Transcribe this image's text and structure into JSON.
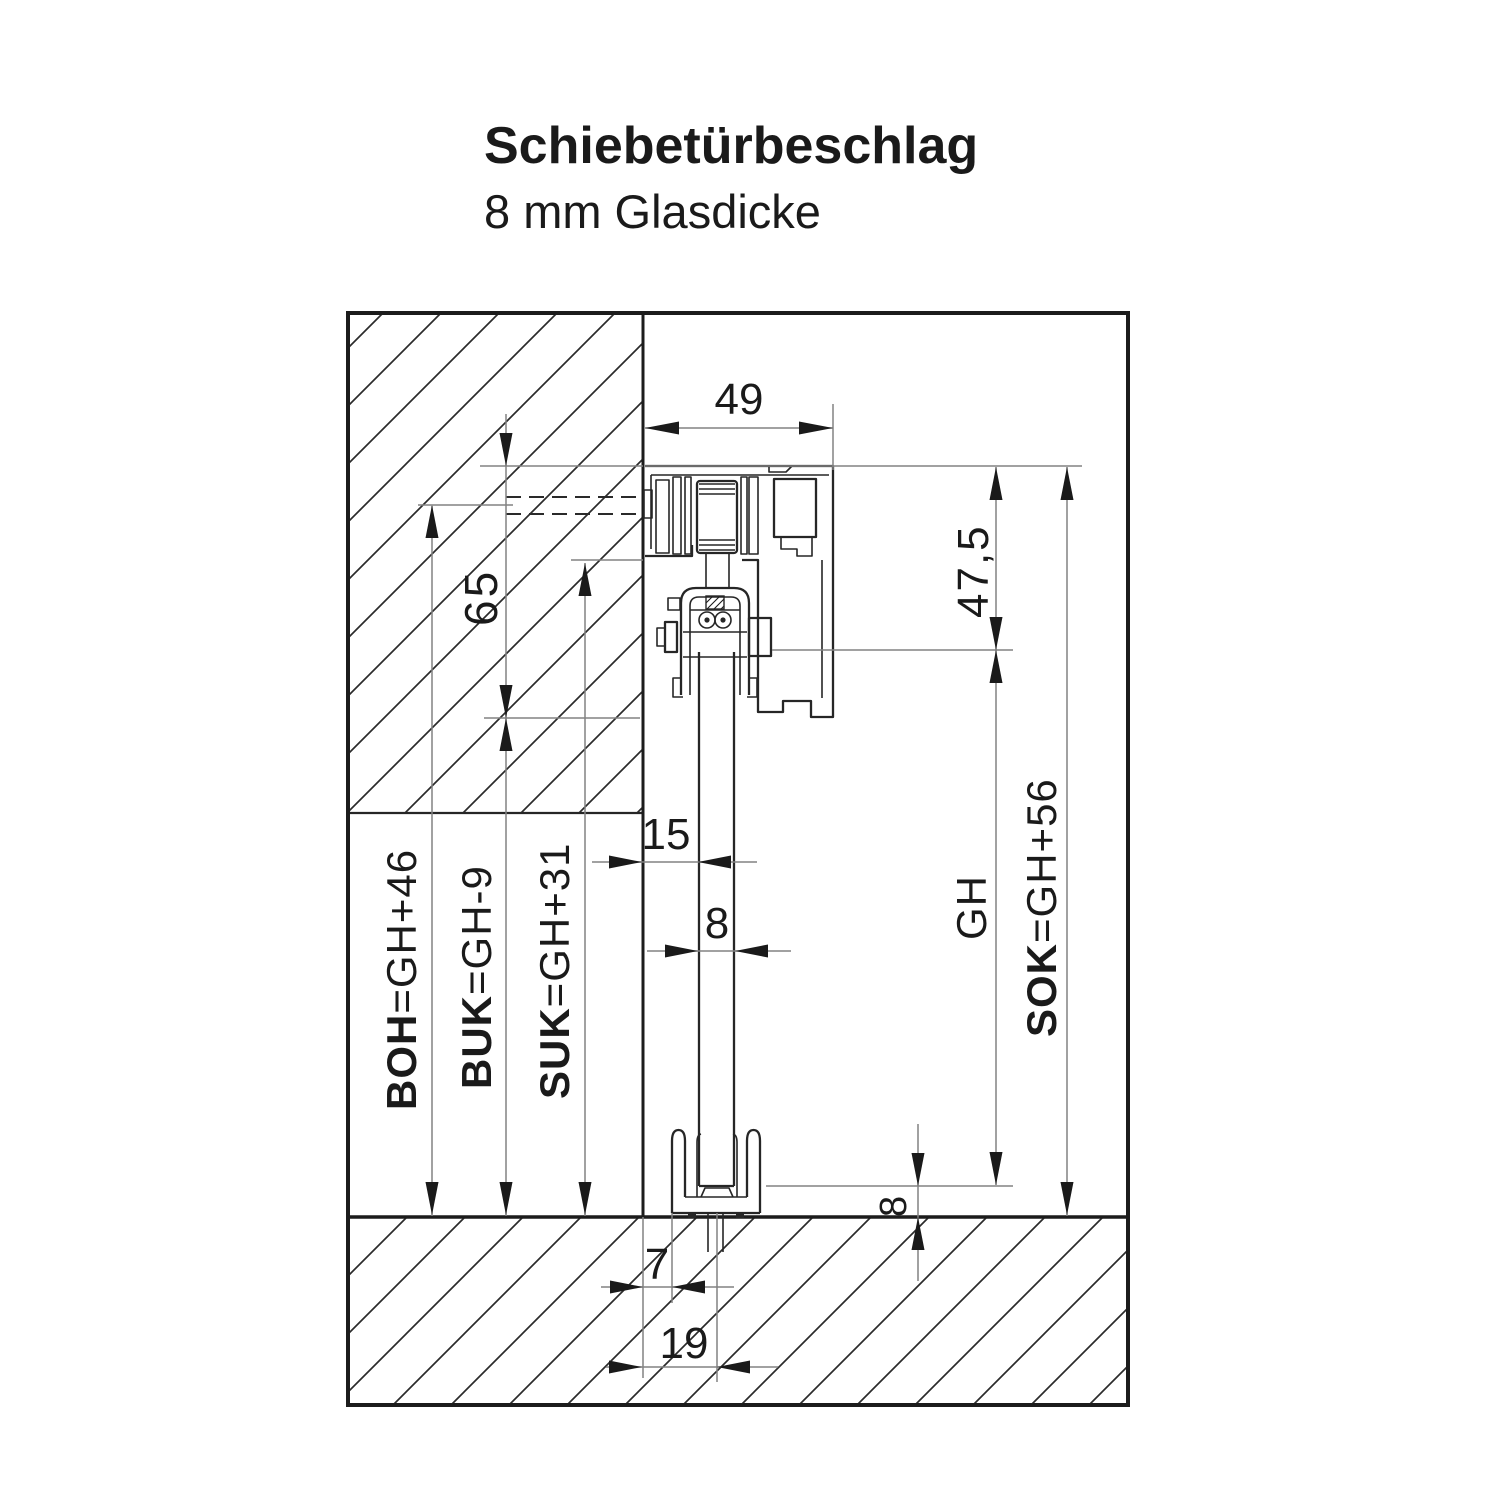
{
  "header": {
    "title": "Schiebetürbeschlag",
    "subtitle": "8 mm Glasdicke"
  },
  "drawing": {
    "type": "cross-section technical drawing of sliding door fitting",
    "dims": {
      "track_width": "49",
      "track_top_to_glass_top": "47,5",
      "track_height": "65",
      "wall_to_glass": "15",
      "glass_thickness": "8",
      "floor_gap": "8",
      "wall_to_guide": "7",
      "wall_to_glass_center": "19",
      "glass_height": "GH",
      "sok_key": "SOK",
      "sok_val": "=GH+56",
      "boh_key": "BOH",
      "boh_val": "=GH+46",
      "buk_key": "BUK",
      "buk_val": "=GH-9",
      "suk_key": "SUK",
      "suk_val": "=GH+31"
    },
    "colors": {
      "ink": "#1a1a1a",
      "drawing_line": "#262626",
      "dimension_line": "#828282",
      "background": "#ffffff"
    }
  }
}
